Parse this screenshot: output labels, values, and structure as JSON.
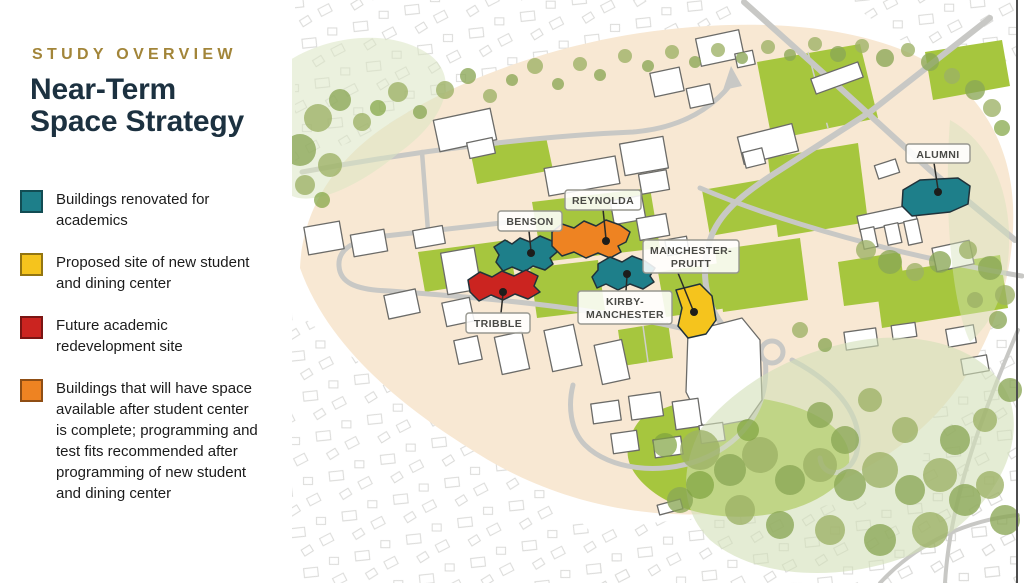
{
  "panel": {
    "eyebrow": "STUDY OVERVIEW",
    "title_line1": "Near-Term",
    "title_line2": "Space Strategy",
    "legend": [
      {
        "label": "Buildings renovated for academics",
        "color": "#1E7F8A"
      },
      {
        "label": "Proposed site of new student and dining center",
        "color": "#F5C41D"
      },
      {
        "label": "Future academic redevelopment site",
        "color": "#CB2420"
      },
      {
        "label": "Buildings that will have space available after student center is complete; programming and test fits recommended after programming of new student and dining center",
        "color": "#EE8322"
      }
    ]
  },
  "map": {
    "colors": {
      "teal": "#1E7F8A",
      "yellow": "#F5C41D",
      "red": "#CB2420",
      "orange": "#EE8322"
    },
    "labels": {
      "alumni": "ALUMNI",
      "reynolda": "REYNOLDA",
      "benson": "BENSON",
      "manchester_pruitt_line1": "MANCHESTER-",
      "manchester_pruitt_line2": "PRUITT",
      "kirby_manchester_line1": "KIRBY-",
      "kirby_manchester_line2": "MANCHESTER",
      "tribble": "TRIBBLE"
    }
  }
}
